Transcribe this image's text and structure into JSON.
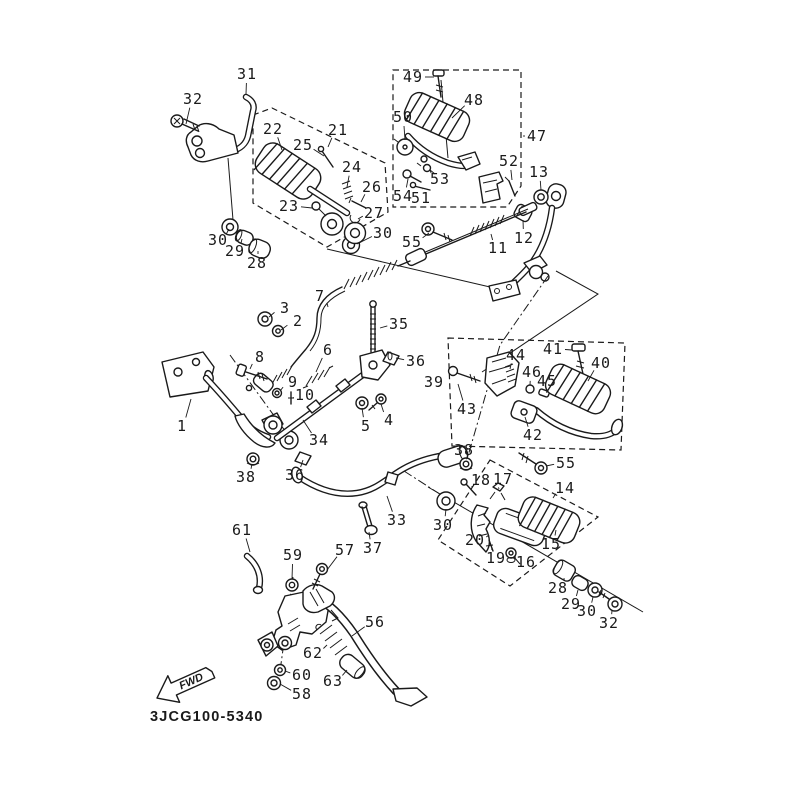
{
  "diagram": {
    "code": "3JCG100-5340",
    "fwd_label": "FWD",
    "colors": {
      "line": "#1a1a1a",
      "background": "#ffffff"
    },
    "labels": [
      {
        "text": "31",
        "x": 247,
        "y": 74,
        "lx": 246,
        "ly": 94
      },
      {
        "text": "32",
        "x": 193,
        "y": 99,
        "lx": 186,
        "ly": 124
      },
      {
        "text": "22",
        "x": 273,
        "y": 129,
        "lx": 282,
        "ly": 150
      },
      {
        "text": "21",
        "x": 338,
        "y": 130,
        "lx": 328,
        "ly": 147
      },
      {
        "text": "25",
        "x": 303,
        "y": 145,
        "lx": 324,
        "ly": 156
      },
      {
        "text": "24",
        "x": 352,
        "y": 167,
        "lx": 347,
        "ly": 187
      },
      {
        "text": "26",
        "x": 372,
        "y": 187,
        "lx": 361,
        "ly": 202
      },
      {
        "text": "23",
        "x": 289,
        "y": 206,
        "lx": 312,
        "ly": 208
      },
      {
        "text": "27",
        "x": 374,
        "y": 213,
        "lx": 358,
        "ly": 219
      },
      {
        "text": "30",
        "x": 218,
        "y": 240,
        "lx": 229,
        "ly": 229
      },
      {
        "text": "29",
        "x": 235,
        "y": 251,
        "lx": 242,
        "ly": 239
      },
      {
        "text": "28",
        "x": 257,
        "y": 263,
        "lx": 258,
        "ly": 251
      },
      {
        "text": "30",
        "x": 383,
        "y": 233,
        "lx": 357,
        "ly": 244
      },
      {
        "text": "49",
        "x": 413,
        "y": 77,
        "lx": 434,
        "ly": 77
      },
      {
        "text": "48",
        "x": 474,
        "y": 100,
        "lx": 452,
        "ly": 118
      },
      {
        "text": "50",
        "x": 403,
        "y": 117,
        "lx": 405,
        "ly": 140
      },
      {
        "text": "47",
        "x": 537,
        "y": 136,
        "lx": 523,
        "ly": 136
      },
      {
        "text": "52",
        "x": 509,
        "y": 161,
        "lx": 512,
        "ly": 180
      },
      {
        "text": "13",
        "x": 539,
        "y": 172,
        "lx": 541,
        "ly": 190
      },
      {
        "text": "53",
        "x": 440,
        "y": 179,
        "lx": 430,
        "ly": 170
      },
      {
        "text": "54",
        "x": 403,
        "y": 196,
        "lx": 408,
        "ly": 179
      },
      {
        "text": "51",
        "x": 421,
        "y": 198,
        "lx": 422,
        "ly": 189
      },
      {
        "text": "55",
        "x": 412,
        "y": 242,
        "lx": 429,
        "ly": 233
      },
      {
        "text": "11",
        "x": 498,
        "y": 248,
        "lx": 491,
        "ly": 234
      },
      {
        "text": "12",
        "x": 524,
        "y": 238,
        "lx": 523,
        "ly": 220
      },
      {
        "text": "7",
        "x": 320,
        "y": 296,
        "lx": 328,
        "ly": 307
      },
      {
        "text": "3",
        "x": 285,
        "y": 308,
        "lx": 269,
        "ly": 317
      },
      {
        "text": "2",
        "x": 298,
        "y": 321,
        "lx": 281,
        "ly": 330
      },
      {
        "text": "35",
        "x": 399,
        "y": 324,
        "lx": 380,
        "ly": 328
      },
      {
        "text": "36",
        "x": 416,
        "y": 361,
        "lx": 396,
        "ly": 358
      },
      {
        "text": "8",
        "x": 260,
        "y": 357,
        "lx": 250,
        "ly": 369
      },
      {
        "text": "6",
        "x": 328,
        "y": 350,
        "lx": 316,
        "ly": 372
      },
      {
        "text": "9",
        "x": 293,
        "y": 382,
        "lx": 280,
        "ly": 391
      },
      {
        "text": "10",
        "x": 305,
        "y": 395,
        "lx": 293,
        "ly": 398
      },
      {
        "text": "1",
        "x": 182,
        "y": 426,
        "lx": 191,
        "ly": 399
      },
      {
        "text": "34",
        "x": 319,
        "y": 440,
        "lx": 303,
        "ly": 420
      },
      {
        "text": "5",
        "x": 366,
        "y": 426,
        "lx": 362,
        "ly": 408
      },
      {
        "text": "4",
        "x": 389,
        "y": 420,
        "lx": 381,
        "ly": 404
      },
      {
        "text": "39",
        "x": 434,
        "y": 382,
        "lx": 446,
        "ly": 382
      },
      {
        "text": "43",
        "x": 467,
        "y": 409,
        "lx": 458,
        "ly": 384
      },
      {
        "text": "44",
        "x": 516,
        "y": 355,
        "lx": 510,
        "ly": 369
      },
      {
        "text": "41",
        "x": 553,
        "y": 349,
        "lx": 572,
        "ly": 350
      },
      {
        "text": "40",
        "x": 601,
        "y": 363,
        "lx": 588,
        "ly": 381
      },
      {
        "text": "46",
        "x": 532,
        "y": 372,
        "lx": 530,
        "ly": 385
      },
      {
        "text": "45",
        "x": 547,
        "y": 381,
        "lx": 544,
        "ly": 390
      },
      {
        "text": "42",
        "x": 533,
        "y": 435,
        "lx": 525,
        "ly": 417
      },
      {
        "text": "38",
        "x": 246,
        "y": 477,
        "lx": 252,
        "ly": 464
      },
      {
        "text": "36",
        "x": 295,
        "y": 475,
        "lx": 303,
        "ly": 460
      },
      {
        "text": "33",
        "x": 397,
        "y": 520,
        "lx": 387,
        "ly": 496
      },
      {
        "text": "37",
        "x": 373,
        "y": 548,
        "lx": 369,
        "ly": 532
      },
      {
        "text": "30",
        "x": 443,
        "y": 525,
        "lx": 446,
        "ly": 509
      },
      {
        "text": "38",
        "x": 464,
        "y": 450,
        "lx": 466,
        "ly": 459
      },
      {
        "text": "18",
        "x": 481,
        "y": 480,
        "lx": 472,
        "ly": 488
      },
      {
        "text": "17",
        "x": 503,
        "y": 479,
        "lx": 499,
        "ly": 489
      },
      {
        "text": "14",
        "x": 565,
        "y": 488,
        "lx": 553,
        "ly": 498
      },
      {
        "text": "55",
        "x": 566,
        "y": 463,
        "lx": 546,
        "ly": 466
      },
      {
        "text": "15",
        "x": 551,
        "y": 544,
        "lx": 556,
        "ly": 530
      },
      {
        "text": "20",
        "x": 475,
        "y": 540,
        "lx": 489,
        "ly": 535
      },
      {
        "text": "19",
        "x": 496,
        "y": 558,
        "lx": 492,
        "ly": 548
      },
      {
        "text": "16",
        "x": 526,
        "y": 562,
        "lx": 515,
        "ly": 556
      },
      {
        "text": "28",
        "x": 558,
        "y": 588,
        "lx": 564,
        "ly": 578
      },
      {
        "text": "29",
        "x": 571,
        "y": 604,
        "lx": 578,
        "ly": 590
      },
      {
        "text": "30",
        "x": 587,
        "y": 611,
        "lx": 593,
        "ly": 597
      },
      {
        "text": "32",
        "x": 609,
        "y": 623,
        "lx": 612,
        "ly": 610
      },
      {
        "text": "61",
        "x": 242,
        "y": 530,
        "lx": 250,
        "ly": 552
      },
      {
        "text": "59",
        "x": 293,
        "y": 555,
        "lx": 292,
        "ly": 579
      },
      {
        "text": "57",
        "x": 345,
        "y": 550,
        "lx": 327,
        "ly": 570
      },
      {
        "text": "56",
        "x": 375,
        "y": 622,
        "lx": 352,
        "ly": 636
      },
      {
        "text": "62",
        "x": 313,
        "y": 653,
        "lx": 327,
        "ly": 645
      },
      {
        "text": "63",
        "x": 333,
        "y": 681,
        "lx": 347,
        "ly": 670
      },
      {
        "text": "60",
        "x": 302,
        "y": 675,
        "lx": 285,
        "ly": 671
      },
      {
        "text": "58",
        "x": 302,
        "y": 694,
        "lx": 280,
        "ly": 684
      }
    ]
  }
}
